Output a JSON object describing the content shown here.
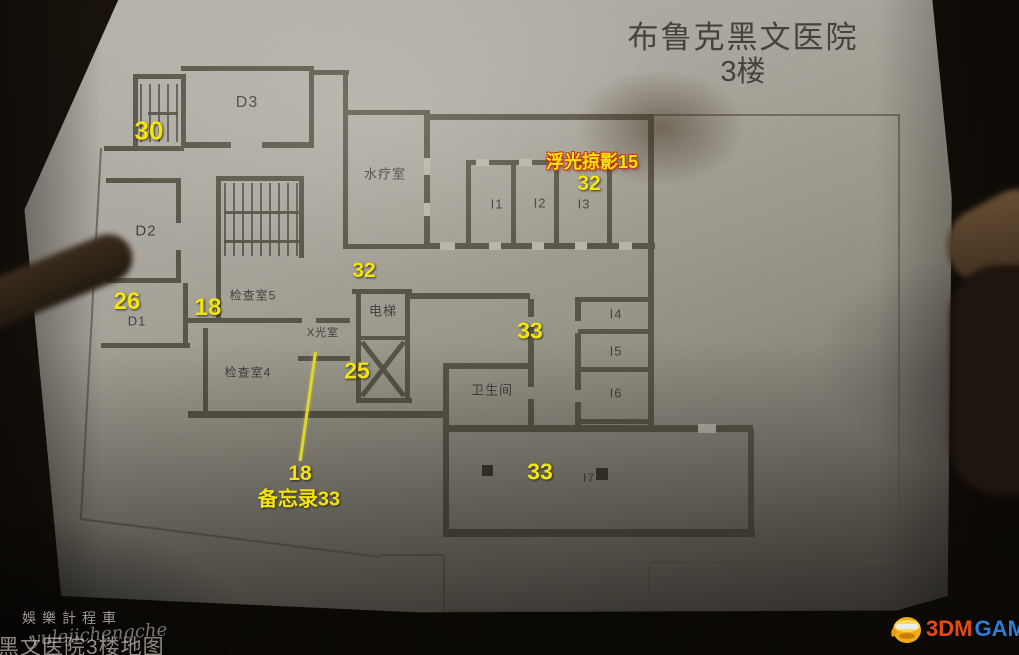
{
  "title": {
    "line1": "布鲁克黑文医院",
    "line2": "3楼"
  },
  "map": {
    "rooms": [
      {
        "id": "d3",
        "label": "D3",
        "x": 247,
        "y": 103,
        "fs": 16
      },
      {
        "id": "d2",
        "label": "D2",
        "x": 146,
        "y": 231,
        "fs": 15
      },
      {
        "id": "d1",
        "label": "D1",
        "x": 137,
        "y": 321,
        "fs": 13
      },
      {
        "id": "hydrotherapy",
        "label": "水疗室",
        "x": 385,
        "y": 173,
        "fs": 13
      },
      {
        "id": "i1",
        "label": "I1",
        "x": 497,
        "y": 204,
        "fs": 13
      },
      {
        "id": "i2",
        "label": "I2",
        "x": 540,
        "y": 203,
        "fs": 13
      },
      {
        "id": "i3",
        "label": "I3",
        "x": 584,
        "y": 204,
        "fs": 13
      },
      {
        "id": "exam5",
        "label": "检查室5",
        "x": 253,
        "y": 295,
        "fs": 12
      },
      {
        "id": "xray",
        "label": "X光室",
        "x": 323,
        "y": 332,
        "fs": 11
      },
      {
        "id": "elevator",
        "label": "电梯",
        "x": 383,
        "y": 310,
        "fs": 13
      },
      {
        "id": "restroom",
        "label": "卫生间",
        "x": 492,
        "y": 389,
        "fs": 13
      },
      {
        "id": "i4",
        "label": "I4",
        "x": 616,
        "y": 314,
        "fs": 13
      },
      {
        "id": "i5",
        "label": "I5",
        "x": 616,
        "y": 351,
        "fs": 13
      },
      {
        "id": "i6",
        "label": "I6",
        "x": 616,
        "y": 393,
        "fs": 13
      },
      {
        "id": "i7",
        "label": "I7",
        "x": 589,
        "y": 478,
        "fs": 12
      },
      {
        "id": "exam4",
        "label": "检查室4",
        "x": 248,
        "y": 372,
        "fs": 12
      }
    ],
    "annotations": [
      {
        "id": "30",
        "text": "30",
        "x": 149,
        "y": 131,
        "fs": 26,
        "cls": "yellow"
      },
      {
        "id": "26",
        "text": "26",
        "x": 127,
        "y": 302,
        "fs": 24,
        "cls": "yellow"
      },
      {
        "id": "18-left",
        "text": "18",
        "x": 208,
        "y": 308,
        "fs": 24,
        "cls": "yellow"
      },
      {
        "id": "32-left",
        "text": "32",
        "x": 364,
        "y": 271,
        "fs": 21,
        "cls": "yellow"
      },
      {
        "id": "photo-15",
        "text": "浮光掠影15",
        "x": 592,
        "y": 161,
        "fs": 18,
        "cls": "red"
      },
      {
        "id": "32-right",
        "text": "32",
        "x": 589,
        "y": 184,
        "fs": 21,
        "cls": "yellow"
      },
      {
        "id": "33-mid",
        "text": "33",
        "x": 530,
        "y": 331,
        "fs": 23,
        "cls": "yellow"
      },
      {
        "id": "25",
        "text": "25",
        "x": 357,
        "y": 371,
        "fs": 23,
        "cls": "yellow"
      },
      {
        "id": "33-bottom",
        "text": "33",
        "x": 540,
        "y": 472,
        "fs": 23,
        "cls": "yellow"
      },
      {
        "id": "18-bottom",
        "text": "18",
        "x": 300,
        "y": 474,
        "fs": 21,
        "cls": "yellow"
      },
      {
        "id": "memo-33",
        "text": "备忘录33",
        "x": 299,
        "y": 497,
        "fs": 20,
        "cls": "yellow"
      }
    ]
  },
  "watermarks": {
    "top": "娛樂計程車",
    "bottom": "黑文医院3楼地图",
    "script": "yulejichengche"
  },
  "logo": {
    "part1": "3DM",
    "part2": "GAME"
  },
  "colors": {
    "marker_yellow": "#f2e40e",
    "marker_red_outline": "#cf3512",
    "wall": "#5a5549",
    "paper": "#aba89f",
    "logo_orange": "#e8490f",
    "logo_blue": "#2e7cd4"
  }
}
